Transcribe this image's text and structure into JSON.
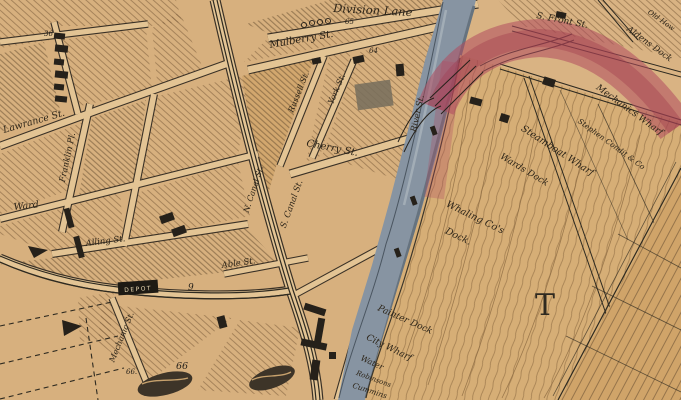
{
  "map": {
    "labels": {
      "division_lane": "Division Lane",
      "mulberry_st": "Mulberry St.",
      "s_front_st": "S. Front St.",
      "lawrance_st": "Lawrance St.",
      "franklin_pl": "Franklin Pl.",
      "ward_st": "Ward",
      "alling_st": "Alling St.",
      "cherry_st": "Cherry St.",
      "russell_st": "Russell St.",
      "york_st": "York St.",
      "n_canal_st": "N. Canal St.",
      "s_canal_st": "S. Canal St.",
      "able_st": "Able St.",
      "mechanic_st": "Mechanic St.",
      "river_st": "River St.",
      "old_partial": "Old How",
      "aldens_dock": "Aldens Dock",
      "mechanics_wharf": "Mechanics Wharf",
      "condit_co": "Stephen Condit & Co",
      "steamboat_wharf": "Steamboat Wharf",
      "wards_dock": "Wards Dock",
      "whaling_line1": "Whaling Co's",
      "whaling_line2": "Dock.",
      "painter_dock": "Painter Dock",
      "city_wharf": "City Wharf",
      "water": "Water",
      "robinsons": "Robinsons",
      "cummins": "Cummins",
      "big_letter": "T",
      "depot": "DEPOT"
    },
    "numbers": {
      "n65": "65",
      "n64": "64",
      "n36": "36",
      "n9": "9",
      "n66a": "66",
      "n66b": "66."
    },
    "colors": {
      "paper": "#d9b383",
      "street": "#e3c494",
      "ink": "#2c2418",
      "hatch": "#7d5f3c",
      "river": "#8794a2",
      "red_band": "#b04a5f"
    }
  }
}
